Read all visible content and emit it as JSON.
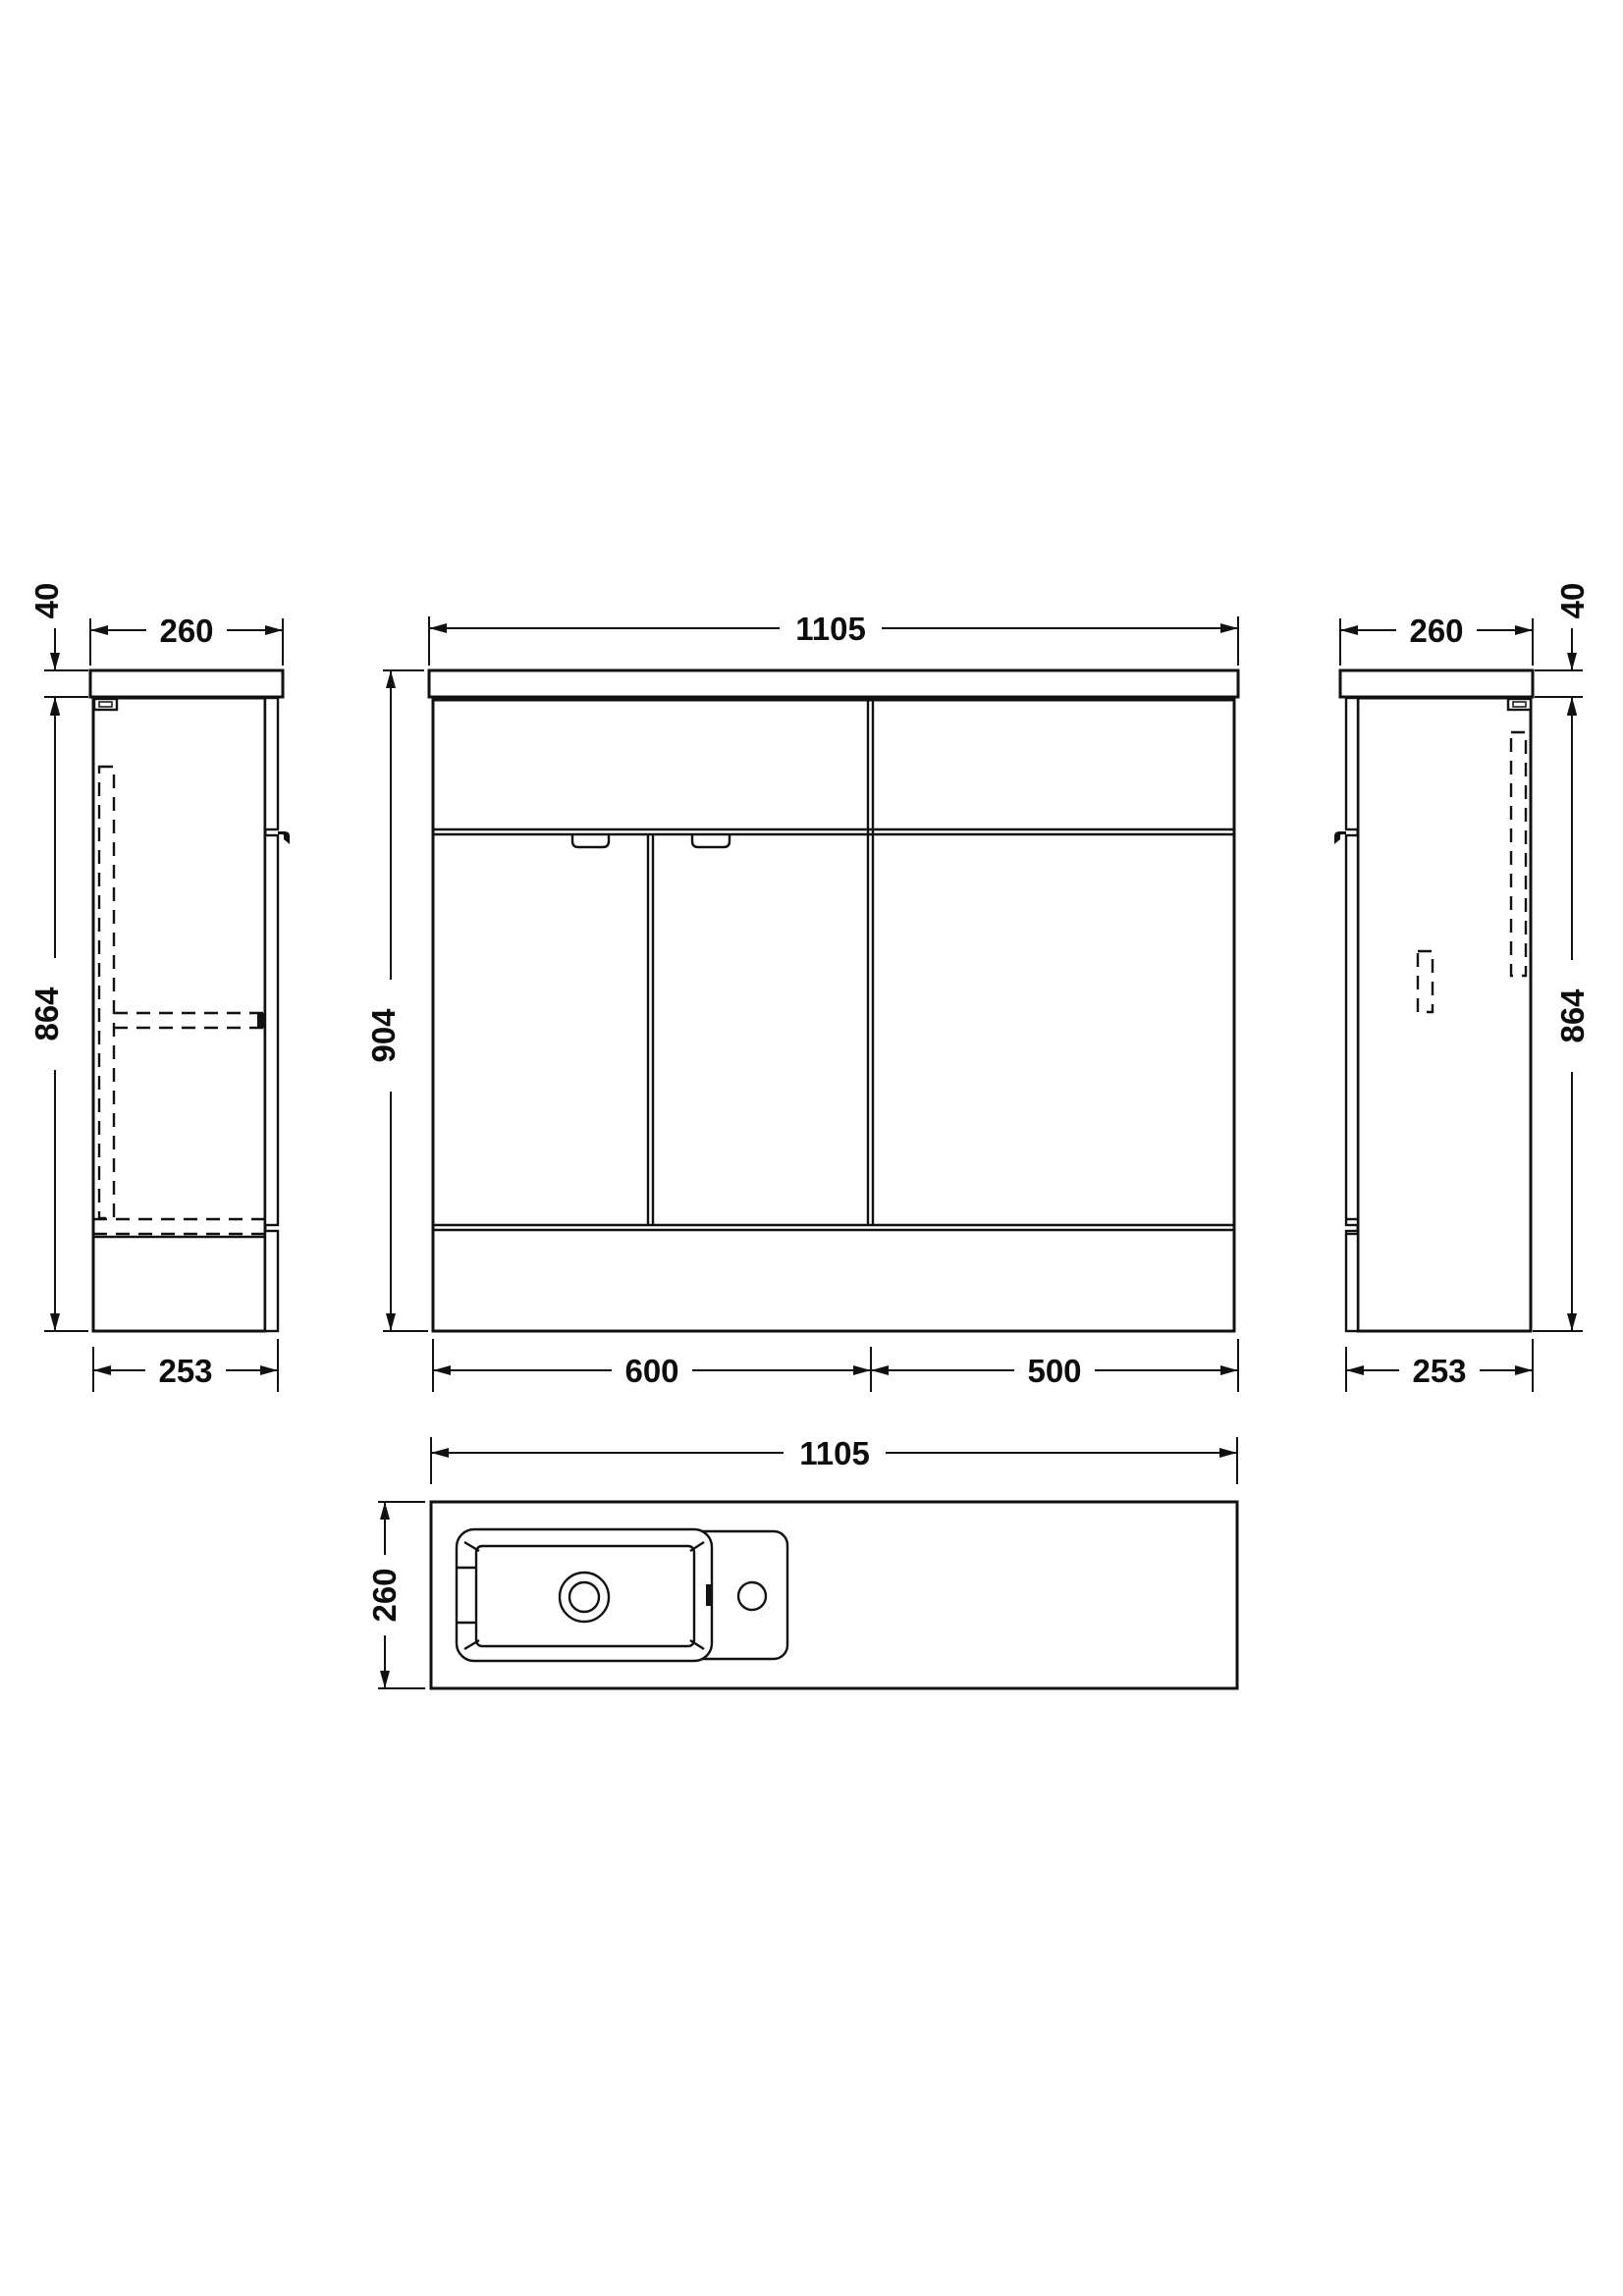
{
  "drawing": {
    "type": "technical-orthographic-drawing",
    "subject": "combination vanity and wc unit",
    "background": "#ffffff",
    "line_color": "#111111",
    "views": {
      "left_side": {
        "top_thickness_mm": "40",
        "top_depth_mm": "260",
        "body_height_mm": "864",
        "base_depth_mm": "253"
      },
      "front": {
        "overall_width_mm": "1105",
        "overall_height_mm": "904",
        "vanity_section_mm": "600",
        "wc_section_mm": "500"
      },
      "right_side": {
        "top_depth_mm": "260",
        "top_thickness_mm": "40",
        "body_height_mm": "864",
        "base_depth_mm": "253"
      },
      "plan": {
        "overall_width_mm": "1105",
        "overall_depth_mm": "260"
      }
    }
  }
}
